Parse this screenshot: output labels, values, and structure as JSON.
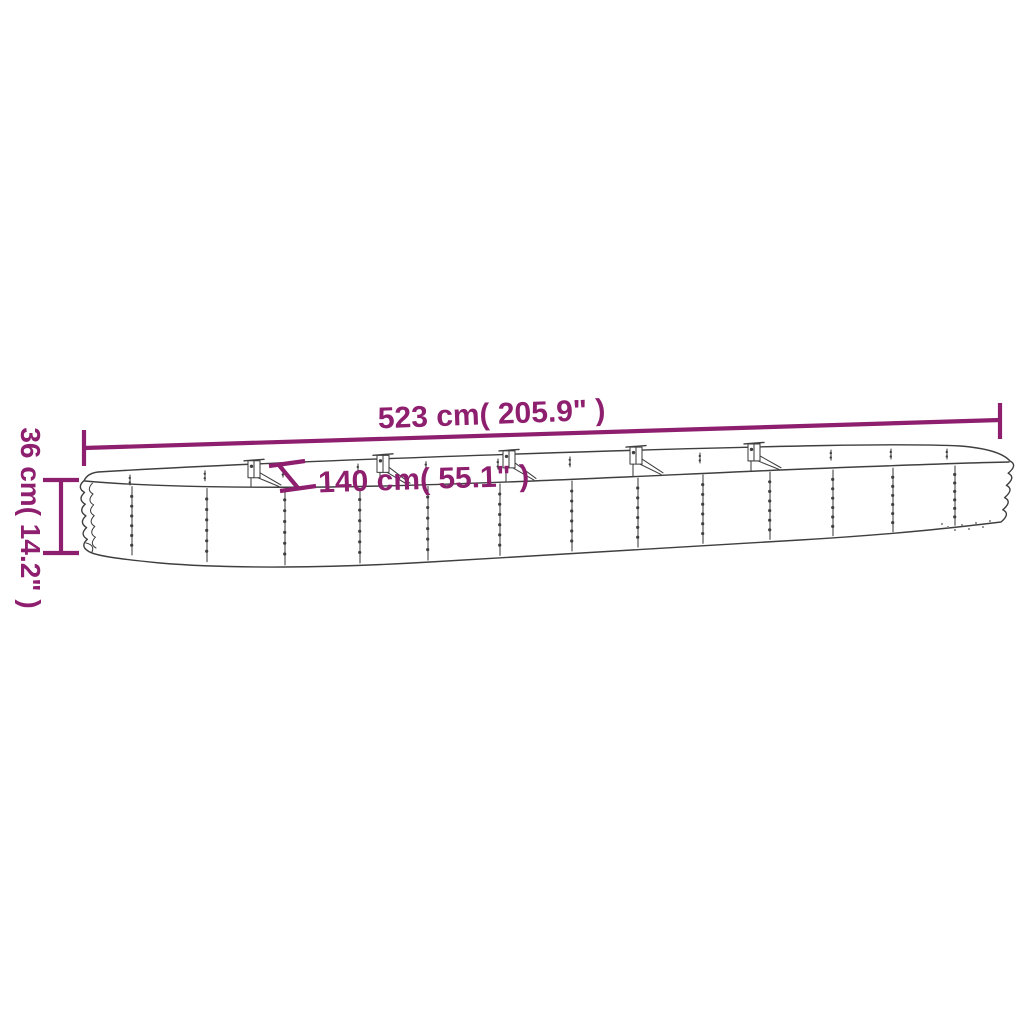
{
  "image_title": "Raised garden bed dimension diagram",
  "colors": {
    "accent": "#8e1e6e",
    "line_art": "#3f3f3f",
    "background": "#ffffff"
  },
  "dimensions": {
    "length": {
      "label": "523 cm( 205.9\" )"
    },
    "width": {
      "label": "140 cm( 55.1\" )"
    },
    "height": {
      "label": "36 cm( 14.2\" )"
    }
  }
}
